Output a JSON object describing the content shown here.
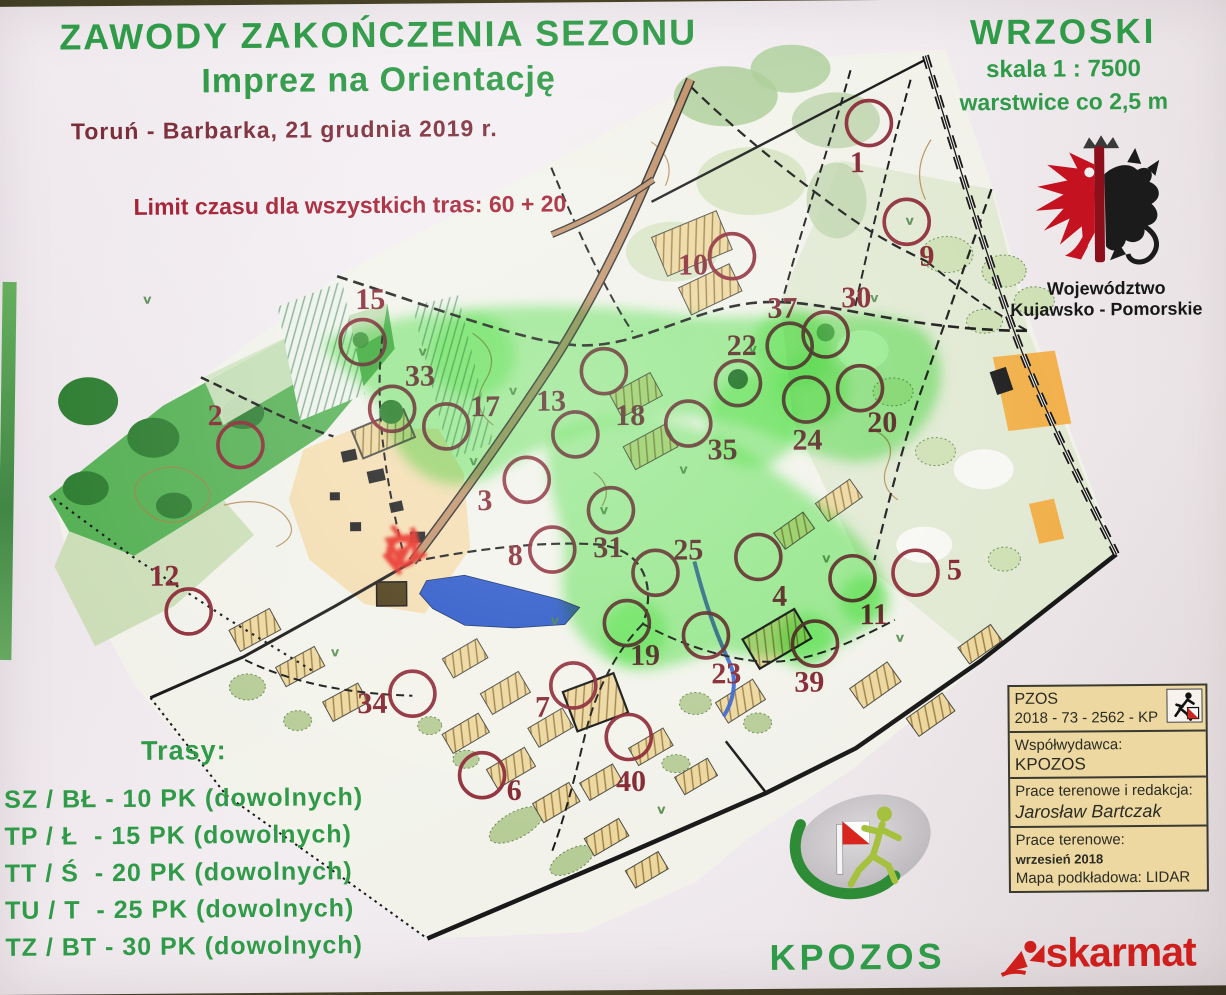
{
  "header": {
    "title_line1": "ZAWODY ZAKOŃCZENIA SEZONU",
    "title_line2": "Imprez na Orientację",
    "subtitle": "Toruń - Barbarka, 21 grudnia 2019 r.",
    "time_limit": "Limit czasu dla wszystkich tras: 60 + 20"
  },
  "map_title_block": {
    "name": "WRZOSKI",
    "scale": "skala 1 : 7500",
    "contours": "warstwice co 2,5 m"
  },
  "emblem": {
    "region_line1": "Województwo",
    "region_line2": "Kujawsko - Pomorskie"
  },
  "courses": {
    "heading": "Trasy:",
    "items": [
      "SZ / BŁ - 10 PK (dowolnych)",
      "TP / Ł  - 15 PK (dowolnych)",
      "TT / Ś  - 20 PK (dowolnych)",
      "TU / T  - 25 PK (dowolnych)",
      "TZ / BT - 30 PK (dowolnych)"
    ]
  },
  "credits_box": {
    "license_line1": "PZOS",
    "license_line2": "2018 - 73 - 2562 - KP",
    "copublisher_label": "Współwydawca:",
    "copublisher": "KPOZOS",
    "fieldwork_label": "Prace terenowe i redakcja:",
    "fieldwork_author": "Jarosław Bartczak",
    "survey_label": "Prace terenowe:",
    "survey_date": "wrzesień  2018",
    "base_map": "Mapa podkładowa: LIDAR"
  },
  "footer": {
    "organizer_logo_text": "KPOZOS",
    "printer_logo_text": "skarmat"
  },
  "colors": {
    "title_green": "#2f9a47",
    "subtitle_maroon": "#7c2d3a",
    "limit_red": "#a31c30",
    "control_red": "#8a2533",
    "highlight_green": "#46e83c",
    "paper": "#f3eff2",
    "credits_bg": "#ecd8a0",
    "skarmat_red": "#ce1f1d"
  },
  "map": {
    "controls": [
      {
        "n": "1",
        "cx": 878,
        "cy": 123,
        "lx": 866,
        "ly": 172
      },
      {
        "n": "2",
        "cx": 247,
        "cy": 440,
        "lx": 222,
        "ly": 420
      },
      {
        "n": "3",
        "cx": 533,
        "cy": 477,
        "lx": 491,
        "ly": 507
      },
      {
        "n": "4",
        "cx": 764,
        "cy": 556,
        "lx": 785,
        "ly": 605
      },
      {
        "n": "5",
        "cx": 921,
        "cy": 573,
        "lx": 960,
        "ly": 580
      },
      {
        "n": "6",
        "cx": 486,
        "cy": 772,
        "lx": 518,
        "ly": 797
      },
      {
        "n": "7",
        "cx": 578,
        "cy": 683,
        "lx": 547,
        "ly": 714
      },
      {
        "n": "8",
        "cx": 558,
        "cy": 547,
        "lx": 521,
        "ly": 562
      },
      {
        "n": "9",
        "cx": 915,
        "cy": 222,
        "lx": 935,
        "ly": 266
      },
      {
        "n": "10",
        "cx": 740,
        "cy": 255,
        "lx": 701,
        "ly": 273
      },
      {
        "n": "11",
        "cx": 858,
        "cy": 578,
        "lx": 879,
        "ly": 624
      },
      {
        "n": "12",
        "cx": 194,
        "cy": 606,
        "lx": 170,
        "ly": 580
      },
      {
        "n": "13",
        "cx": 582,
        "cy": 432,
        "lx": 558,
        "ly": 408
      },
      {
        "n": "15",
        "cx": 370,
        "cy": 338,
        "lx": 378,
        "ly": 305
      },
      {
        "n": "17",
        "cx": 453,
        "cy": 423,
        "lx": 492,
        "ly": 413
      },
      {
        "n": "18",
        "cx": 611,
        "cy": 369,
        "lx": 637,
        "ly": 423
      },
      {
        "n": "19",
        "cx": 632,
        "cy": 621,
        "lx": 650,
        "ly": 663
      },
      {
        "n": "20",
        "cx": 867,
        "cy": 388,
        "lx": 889,
        "ly": 432
      },
      {
        "n": "22",
        "cx": 745,
        "cy": 382,
        "lx": 749,
        "ly": 354
      },
      {
        "n": "23",
        "cx": 711,
        "cy": 634,
        "lx": 731,
        "ly": 682
      },
      {
        "n": "24",
        "cx": 813,
        "cy": 399,
        "lx": 814,
        "ly": 449
      },
      {
        "n": "25",
        "cx": 661,
        "cy": 571,
        "lx": 694,
        "ly": 558
      },
      {
        "n": "30",
        "cx": 833,
        "cy": 334,
        "lx": 864,
        "ly": 307
      },
      {
        "n": "31",
        "cx": 617,
        "cy": 508,
        "lx": 614,
        "ly": 555
      },
      {
        "n": "33",
        "cx": 399,
        "cy": 405,
        "lx": 427,
        "ly": 382
      },
      {
        "n": "34",
        "cx": 417,
        "cy": 690,
        "lx": 377,
        "ly": 709
      },
      {
        "n": "35",
        "cx": 695,
        "cy": 422,
        "lx": 729,
        "ly": 458
      },
      {
        "n": "37",
        "cx": 797,
        "cy": 345,
        "lx": 790,
        "ly": 317
      },
      {
        "n": "39",
        "cx": 820,
        "cy": 643,
        "lx": 814,
        "ly": 691
      },
      {
        "n": "40",
        "cx": 633,
        "cy": 735,
        "lx": 635,
        "ly": 789
      }
    ]
  }
}
